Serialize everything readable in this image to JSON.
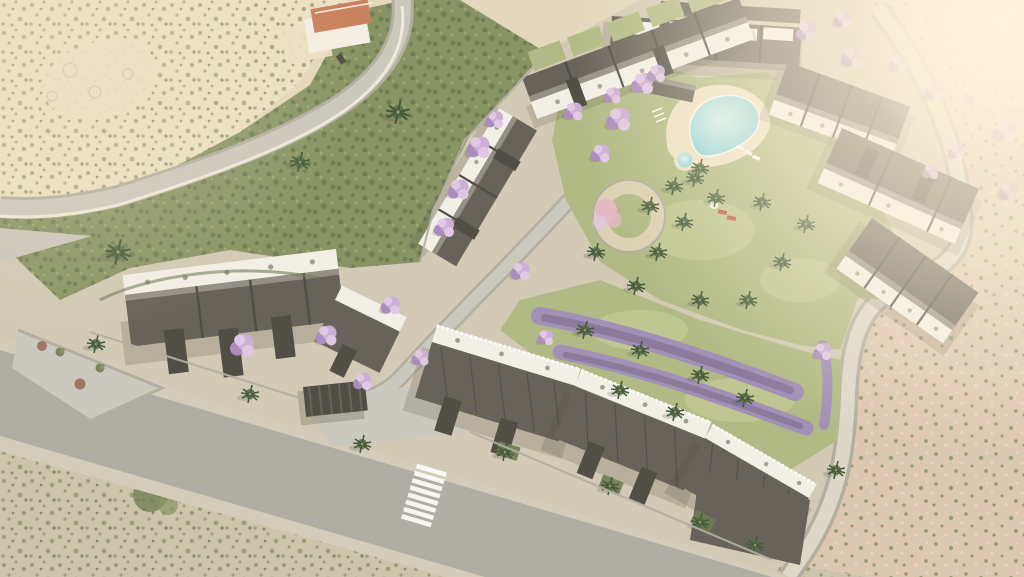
{
  "scene": {
    "type": "aerial-architectural-render",
    "description": "Photorealistic CGI aerial view of a hillside residential development: five modern apartment blocks with white roof terraces and dark facades arranged around a communal garden with a free-form swimming pool, kids pool, circular sand plaza, lavender beds, palms and flowering jacaranda trees. A wide asphalt access road with zebra crossing runs along the lower edge, a curving hill road with retaining wall crosses the upper left past an existing white villa with a terracotta roof, and dry Mediterranean scrubland surrounds the site with warm sun glare from the upper right.",
    "image": {
      "width": 1024,
      "height": 577
    },
    "elements": {
      "buildings": [
        {
          "id": "top-block",
          "label": "north apartment block"
        },
        {
          "id": "upper-terrace-row",
          "label": "upper stepped terrace row"
        },
        {
          "id": "west-terrace-row",
          "label": "west stepped terrace row"
        },
        {
          "id": "west-block",
          "label": "west apartment block"
        },
        {
          "id": "east-block",
          "label": "east apartment cluster (3 wings)"
        },
        {
          "id": "south-block",
          "label": "south apartment cluster (3 wings)"
        },
        {
          "id": "villa",
          "label": "existing villa with terracotta roof"
        }
      ],
      "amenities": [
        {
          "id": "main-pool",
          "label": "free-form swimming pool"
        },
        {
          "id": "kids-pool",
          "label": "round children's pool"
        },
        {
          "id": "circular-plaza",
          "label": "circular sand plaza with blossom tree"
        },
        {
          "id": "lavender-beds",
          "label": "diagonal lavender planting bands"
        },
        {
          "id": "entrance-gate",
          "label": "dark flat-roof entrance canopy"
        }
      ],
      "circulation": [
        {
          "id": "main-road",
          "label": "wide asphalt road with sidewalks and zebra crossing"
        },
        {
          "id": "hill-road",
          "label": "curving hill road with white retaining wall"
        },
        {
          "id": "internal-road",
          "label": "internal lane with small zebra crossing"
        },
        {
          "id": "perimeter-path",
          "label": "paved perimeter walkway on the east side"
        }
      ],
      "vegetation": [
        {
          "id": "jacaranda",
          "label": "purple jacaranda trees"
        },
        {
          "id": "palms",
          "label": "palm trees"
        },
        {
          "id": "scrub",
          "label": "dry speckled scrubland"
        },
        {
          "id": "hill-forest",
          "label": "dense green hillside vegetation"
        }
      ],
      "details": [
        {
          "id": "car",
          "label": "car on hill road"
        },
        {
          "id": "red-loungers",
          "label": "red sun loungers on lawn"
        },
        {
          "id": "crosswalks_count",
          "label": 2
        }
      ]
    },
    "palette": {
      "sand": "#e0d5b8",
      "sand_light": "#ebdfc2",
      "scrub_gray": "#c8c0a6",
      "pink": "#d9c2ac",
      "pink_light": "#e7d3be",
      "hill": "#7c8a58",
      "hill_dark": "#5f6e44",
      "lawn": "#a9b47c",
      "lawn_light": "#c4cc94",
      "ground": "#cdc6b1",
      "road": "#a7a5a0",
      "road_light": "#c6c3ba",
      "path": "#d9d4c6",
      "sidewalk": "#cfc8b6",
      "wall": "#aaa79b",
      "wall_light": "#ece8dc",
      "building_dark": "#57534c",
      "building_tower": "#3e3b36",
      "building_roof": "#8a857c",
      "building_white": "#f1efe8",
      "villa_roof": "#c3734f",
      "villa_white": "#f3efe6",
      "pool_water": "#7ecdd8",
      "pool_water_light": "#d2f0f2",
      "pool_deck": "#ecdfc2",
      "plaza": "#d9cdae",
      "jacaranda": "#c7a7d6",
      "jacaranda_light": "#ddc2e6",
      "jacaranda_dark": "#a380ba",
      "pink_tree": "#e2b3c1",
      "lavender": "#9886b4",
      "lavender_dark": "#77678f",
      "palm": "#46633a",
      "palm_dark": "#314a28",
      "trunk": "#94846a",
      "shrub_red": "#96685a",
      "lounger_red": "#b54a39",
      "glow": "#fff4dc",
      "shadow": "#3b382f",
      "white": "#ffffff"
    }
  }
}
